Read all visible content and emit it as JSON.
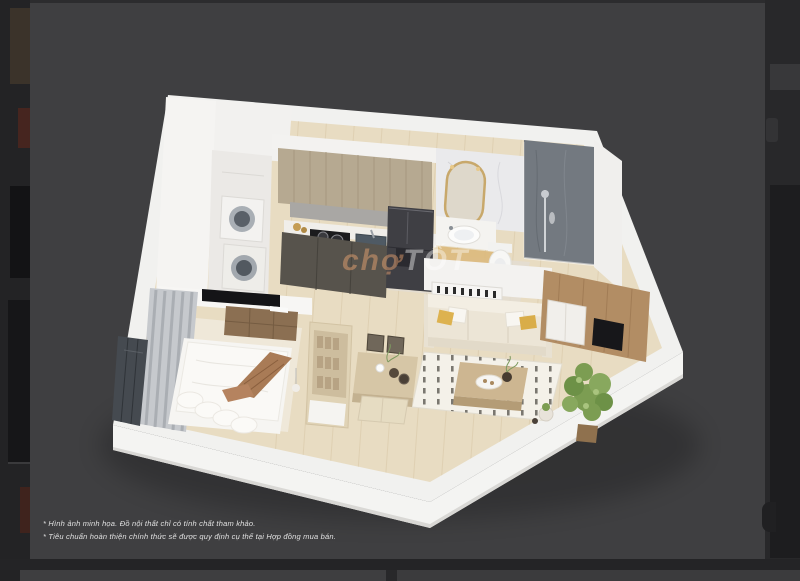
{
  "viewer": {
    "photo_background": "#3f3f41",
    "page_background": "#28282a",
    "watermark": {
      "prefix": "chợ",
      "suffix": "TỐT"
    },
    "disclaimers": {
      "line1": "* Hình ảnh minh họa. Đồ nội thất chỉ có tính chất tham khảo.",
      "line2": "* Tiêu chuẩn hoàn thiện chính thức sẽ được quy định cụ thể tại Hợp đồng mua bán."
    }
  },
  "floorplan_render": {
    "type": "3d-isometric-apartment",
    "rooms_depicted": [
      "laundry-closet",
      "kitchen",
      "bathroom",
      "shower",
      "living-room",
      "dining-area",
      "bedroom"
    ],
    "furniture_depicted": [
      "stacked-washer-dryer",
      "upper-cabinets",
      "cooktop",
      "sink",
      "refrigerator",
      "vanity-mirror",
      "wash-basin",
      "toilet",
      "shower-set",
      "sofa",
      "coffee-table",
      "rug",
      "tv-media-wall",
      "potted-plant",
      "dining-table",
      "dining-chairs",
      "bench",
      "shelf-unit",
      "bed",
      "dresser",
      "wall-tv",
      "curtains",
      "window"
    ],
    "palette": {
      "walls": "#f1f1ef",
      "wood_floor": "#e8dcc2",
      "upper_cabinets": "#b6a991",
      "lower_cabinets": "#57534c",
      "fridge": "#3f3f44",
      "shower_marble": "#737980",
      "mirror_frame": "#c8a86b",
      "sofa": "#ece5d6",
      "accent_pillow": "#ddb24f",
      "bed_throw": "#a97b56",
      "media_wood": "#b28d64",
      "plant": "#7c9d52"
    }
  }
}
